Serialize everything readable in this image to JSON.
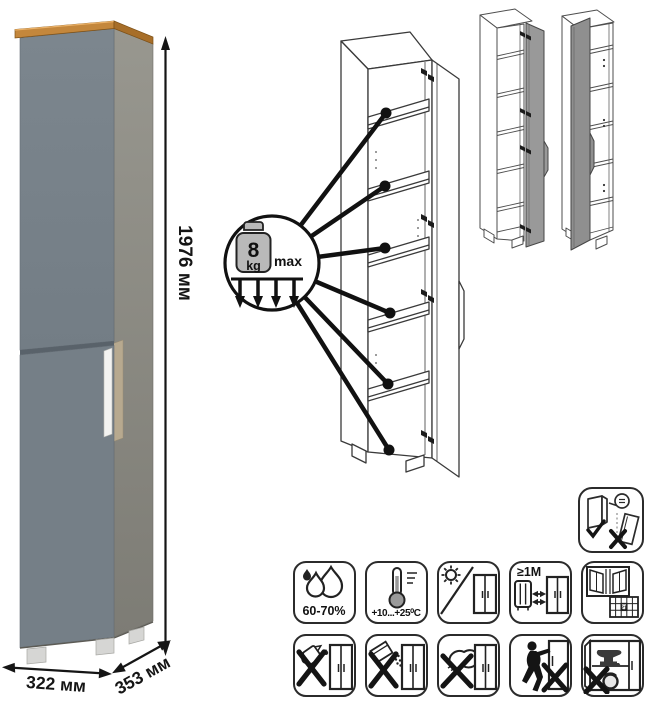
{
  "dimensions": {
    "height": "1976 мм",
    "width": "322 мм",
    "depth": "353 мм"
  },
  "shelf_load": {
    "value": "8",
    "unit": "kg",
    "qualifier": "max",
    "callout_count": 6
  },
  "door_variants": [
    "door-hinged-right",
    "door-hinged-left"
  ],
  "care": {
    "humidity": "60-70%",
    "temperature": "+10...+25⁰C",
    "heat_distance": "≥1М",
    "airing_day": "21"
  },
  "icons": {
    "standalone": "secure-to-wall",
    "row1": [
      "humidity",
      "temperature",
      "no-direct-sunlight",
      "heat-source-distance",
      "ventilation-calendar"
    ],
    "row2": [
      "no-liquids",
      "no-abrasive-powder",
      "no-scrubbing",
      "no-dragging",
      "no-heavy-objects"
    ]
  },
  "colors": {
    "wood_top": "#c4873c",
    "door_gray": "#79838b",
    "side_gray": "#8a8983",
    "handle_white": "#f3f3f1",
    "line_art": "#3a3a3a",
    "icon_border": "#2b2b2b",
    "variant_door_gray": "#969696"
  }
}
